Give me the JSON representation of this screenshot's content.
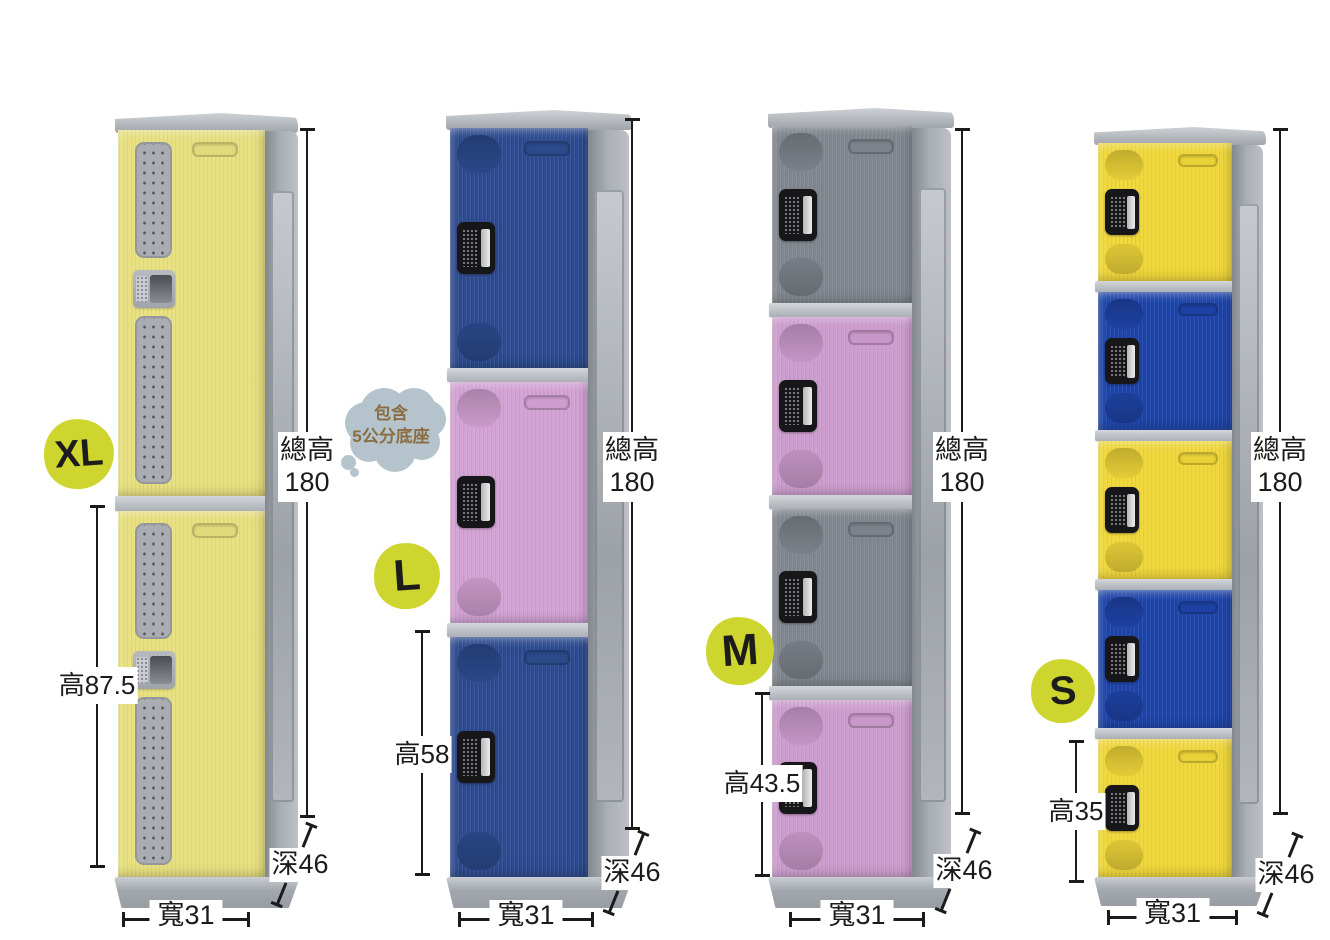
{
  "note_bubble": {
    "line1": "包含",
    "line2": "5公分底座"
  },
  "lockers": [
    {
      "size_badge": "XL",
      "total_height_label": "總高",
      "total_height_value": "180",
      "compartment_height": "高87.5",
      "depth": "深46",
      "width": "寬31",
      "compartments": 2,
      "door_style": "vented",
      "door_colors": [
        "#e9e080",
        "#e9e080"
      ]
    },
    {
      "size_badge": "L",
      "total_height_label": "總高",
      "total_height_value": "180",
      "compartment_height": "高58",
      "depth": "深46",
      "width": "寬31",
      "compartments": 3,
      "door_style": "panel",
      "door_colors": [
        "#2d4b8e",
        "#d3a2d4",
        "#2d4b8e"
      ]
    },
    {
      "size_badge": "M",
      "total_height_label": "總高",
      "total_height_value": "180",
      "compartment_height": "高43.5",
      "depth": "深46",
      "width": "寬31",
      "compartments": 4,
      "door_style": "panel",
      "door_colors": [
        "#81878f",
        "#cd9dcf",
        "#81878f",
        "#cd9dcf"
      ]
    },
    {
      "size_badge": "S",
      "total_height_label": "總高",
      "total_height_value": "180",
      "compartment_height": "高35",
      "depth": "深46",
      "width": "寬31",
      "compartments": 5,
      "door_style": "panel",
      "door_colors": [
        "#f0d73a",
        "#1e44a8",
        "#f0d73a",
        "#1e44a8",
        "#f0d73a"
      ]
    }
  ],
  "palette": {
    "badge_fill": "#cdd52e",
    "badge_text": "#1c1c1c",
    "dimension_ink": "#1b1b1b",
    "bubble_fill": "#b5c3cd",
    "bubble_text": "#8a6e42",
    "cabinet_gray": "#a5aab0",
    "vent_gray": "#a9adb2",
    "lock_plate": "#17171a"
  }
}
